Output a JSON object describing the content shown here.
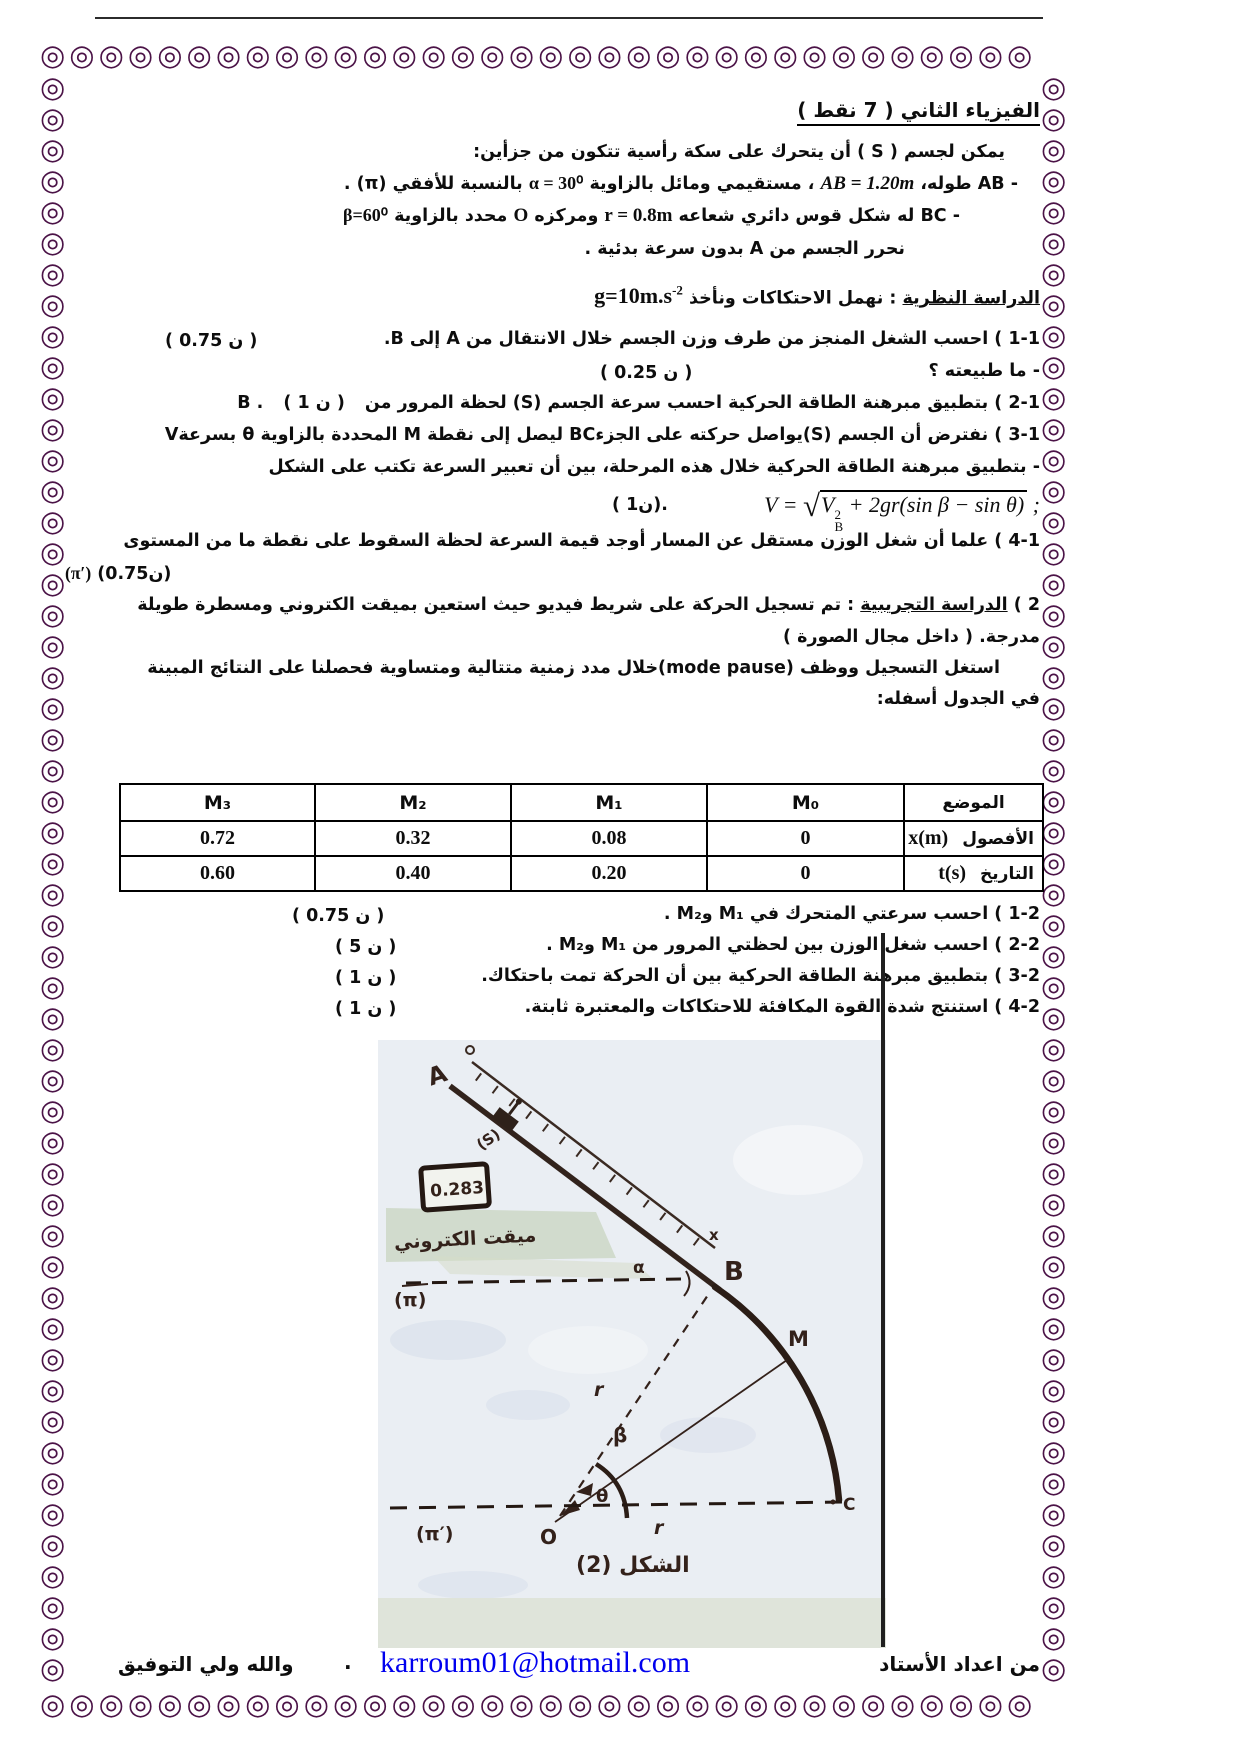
{
  "page": {
    "title": "الفيزياء الثاني ( 7 نقط )"
  },
  "border": {
    "glyph": "◎",
    "color": "#4b1347"
  },
  "intro": {
    "line1": "يمكن لجسم ( S ) أن يتحرك على سكة رأسية تتكون من جزأين:",
    "ab_pre": "- AB طوله،",
    "ab_formula": "AB = 1.20m",
    "ab_mid": "، مستقيمي ومائل بالزاوية",
    "ab_alpha": "α = 30⁰",
    "ab_post": "بالنسبة للأفقي (π) .",
    "bc_pre": "- BC له شكل قوس دائري شعاعه",
    "bc_r": "r = 0.8m",
    "bc_mid": "ومركزه",
    "bc_center": "O",
    "bc_mid2": "محدد بالزاوية",
    "bc_beta": "β=60⁰",
    "release": "نحرر الجسم من A بدون سرعة بدئية ."
  },
  "theory": {
    "heading": "الدراسة النظرية",
    "heading_rest": ": نهمل الاحتكاكات ونأخذ",
    "g_value": "g=10m.s",
    "g_sup": "-2",
    "q1_text": "1-1 ) احسب الشغل المنجز من طرف وزن الجسم خلال الانتقال من A إلى B.",
    "q1_mark": "( 0.75 ن )",
    "q1b_text": "- ما طبيعته ؟",
    "q1b_mark": "( 0.25 ن )",
    "q2_text": "2-1 ) بتطبيق مبرهنة الطاقة الحركية احسب سرعة الجسم (S) لحظة المرور من B .",
    "q2_mark": "( 1 ن )",
    "q3_text": "3-1 ) نفترض أن الجسم (S)يواصل حركته على الجزءBC ليصل إلى نقطة M المحددة بالزاوية θ بسرعةV",
    "q3b_text": "- بتطبيق مبرهنة الطاقة الحركية خلال هذه المرحلة، بين أن تعبير السرعة تكتب على الشكل",
    "formula_lhs": "V = ",
    "formula_rad_v": "V",
    "formula_sup": "2",
    "formula_sub": "B",
    "formula_rest": " + 2gr(sin β − sin θ)",
    "formula_close": " ;",
    "formula_mark": "( 1ن).",
    "q4_text": "4-1 ) علما أن شغل الوزن مستقل عن المسار أوجد قيمة السرعة لحظة السقوط على نقطة ما من المستوى",
    "q4_plane": "(π′)",
    "q4_mark": "(0.75ن)"
  },
  "experiment": {
    "num": "2 )",
    "heading": "الدراسة التجريبية",
    "text1": ": تم تسجيل الحركة على شريط فيديو حيث استعين بميقت الكتروني ومسطرة طويلة",
    "text2": "مدرجة. ( داخل مجال الصورة )",
    "text3": "استغل التسجيل ووظف (mode pause)خلال مدد زمنية متتالية ومتساوية فحصلنا على النتائج المبينة",
    "text4": "في الجدول أسفله:"
  },
  "table": {
    "pos_header": "الموضع",
    "cols": [
      "M₀",
      "M₁",
      "M₂",
      "M₃"
    ],
    "row_x_label": "الأفصول",
    "row_x_sym": "x(m)",
    "row_x": [
      "0",
      "0.08",
      "0.32",
      "0.72"
    ],
    "row_t_label": "التاريخ",
    "row_t_sym": "t(s)",
    "row_t": [
      "0",
      "0.20",
      "0.40",
      "0.60"
    ]
  },
  "part2": {
    "q1_text": "1-2 ) احسب سرعتي المتحرك في M₁ وM₂ .",
    "q1_mark": "( 0.75 ن )",
    "q2_text": "2-2 ) احسب شغل الوزن بين لحظتي المرور من M₁ وM₂ .",
    "q2_mark": "( 5 ن )",
    "q3_text": "3-2 ) بتطبيق مبرهنة الطاقة الحركية بين أن الحركة تمت باحتكاك.",
    "q3_mark": "( 1 ن )",
    "q4_text": "4-2 ) استنتج شدة القوة المكافئة للاحتكاكات والمعتبرة ثابتة.",
    "q4_mark": "( 1 ن )"
  },
  "figure": {
    "label_a": "A",
    "label_b": "B",
    "label_m": "M",
    "label_c": "C",
    "label_o": "O",
    "label_x": "x",
    "label_s": "(S)",
    "label_alpha": "α",
    "label_beta": "β",
    "label_theta": "θ",
    "label_r1": "r",
    "label_r2": "r",
    "label_pi": "(π)",
    "label_pi_prime": "(π′)",
    "timer_value": "0.283",
    "timer_label": "ميقت الكتروني",
    "caption": "الشكل (2)"
  },
  "footer": {
    "author": "من اعداد الأستاد",
    "email": "karroum01@hotmail.com",
    "dot": ".",
    "blessing": "والله ولي التوفيق"
  }
}
